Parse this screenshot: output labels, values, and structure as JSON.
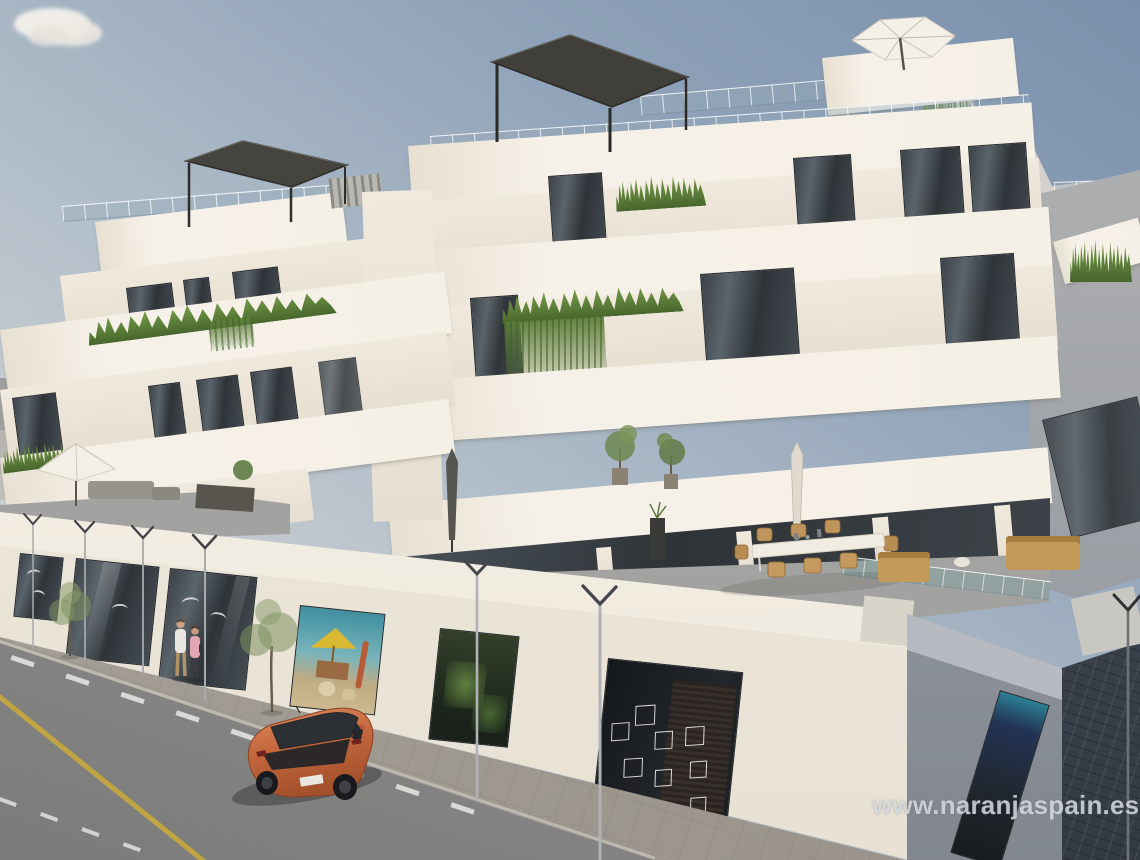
{
  "watermark": {
    "text": "www.naranjaspain.es",
    "color": "#d3d8dd"
  },
  "scene": {
    "type": "architectural-render",
    "subject": "Modern white stepped apartment building with rooftop pergolas and terraces, balconies with plants, ground-floor shop windows, and a street with a parked orange hatchback",
    "objects": [
      "apartment-building",
      "rooftop-pergola",
      "rooftop-cantilever-umbrella",
      "glass-balustrades",
      "balcony-planters",
      "hanging-plants",
      "podium-terrace",
      "terrace-dining-set",
      "terrace-lounge-furniture",
      "open-patio-umbrella",
      "closed-parasols",
      "potted-trees",
      "shop-windows",
      "beach-display-window",
      "cube-shelf-display-window",
      "street",
      "sidewalk",
      "side-street",
      "street-lamps",
      "sidewalk-trees",
      "pedestrians",
      "orange-hatchback-car",
      "cloud",
      "road-markings"
    ],
    "counts": {
      "pedestrians": 2,
      "cars": 1,
      "sidewalk_trees": 2,
      "street_lamps": 7,
      "clouds": 1,
      "rooftop_pergolas": 2
    }
  },
  "colors": {
    "sky_top": "#7b90ad",
    "sky_horizon": "#dcdad4",
    "facade_sunlit": "#efe8dc",
    "facade_bright": "#f6f1e8",
    "facade_shadow": "#d9d2c5",
    "side_face_gray": "#949aa3",
    "window_glass": "#31363c",
    "glass_railing": "#a9b8c2",
    "plant_green": "#5f7f3e",
    "terrace_floor": "#a7a7a5",
    "road_asphalt": "#8d8d8c",
    "sidewalk": "#a7a29a",
    "side_street_paving": "#3d434d",
    "road_line_yellow": "#c7a83e",
    "lane_dash_white": "#e8e8e5",
    "car_orange": "#c4663c",
    "umbrella_white": "#f2efe7",
    "pergola_dark": "#45443e",
    "watermark_gray": "#d3d8dd"
  }
}
